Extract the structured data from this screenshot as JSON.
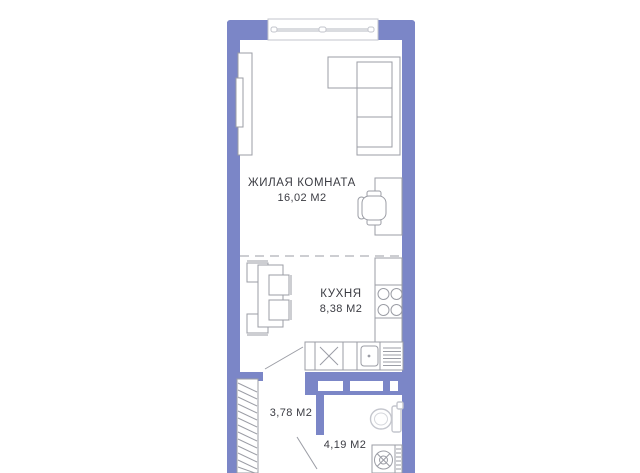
{
  "plan": {
    "rooms": {
      "living_room": {
        "name": "ЖИЛАЯ КОМНАТА",
        "area": "16,02 М2"
      },
      "kitchen": {
        "name": "КУХНЯ",
        "area": "8,38 М2"
      },
      "hallway": {
        "area": "3,78 М2"
      },
      "bathroom": {
        "area": "4,19 М2"
      }
    },
    "colors": {
      "wall": "#7b86c7",
      "furniture_outline": "#9b9da5",
      "fixture_outline": "#c4c6cd",
      "text": "#3b3c43",
      "background": "#ffffff"
    }
  }
}
